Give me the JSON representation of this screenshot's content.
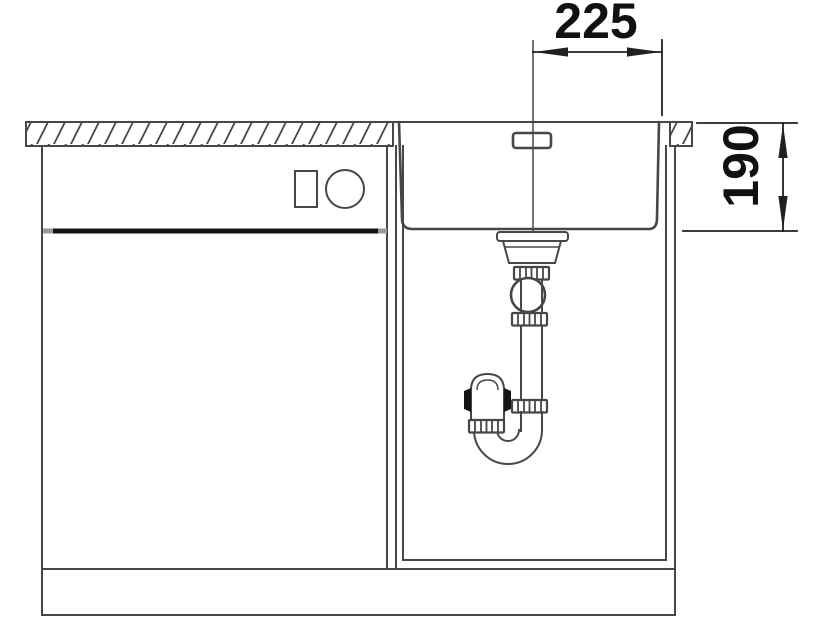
{
  "drawing": {
    "labels": {
      "width_mm": "225",
      "depth_mm": "190"
    }
  },
  "colors": {
    "background": "#ffffff",
    "line": "#474747",
    "line_strong": "#202020",
    "line_light": "#9b9b9b",
    "line_thick": "#141414",
    "dimension_text": "#111111"
  }
}
